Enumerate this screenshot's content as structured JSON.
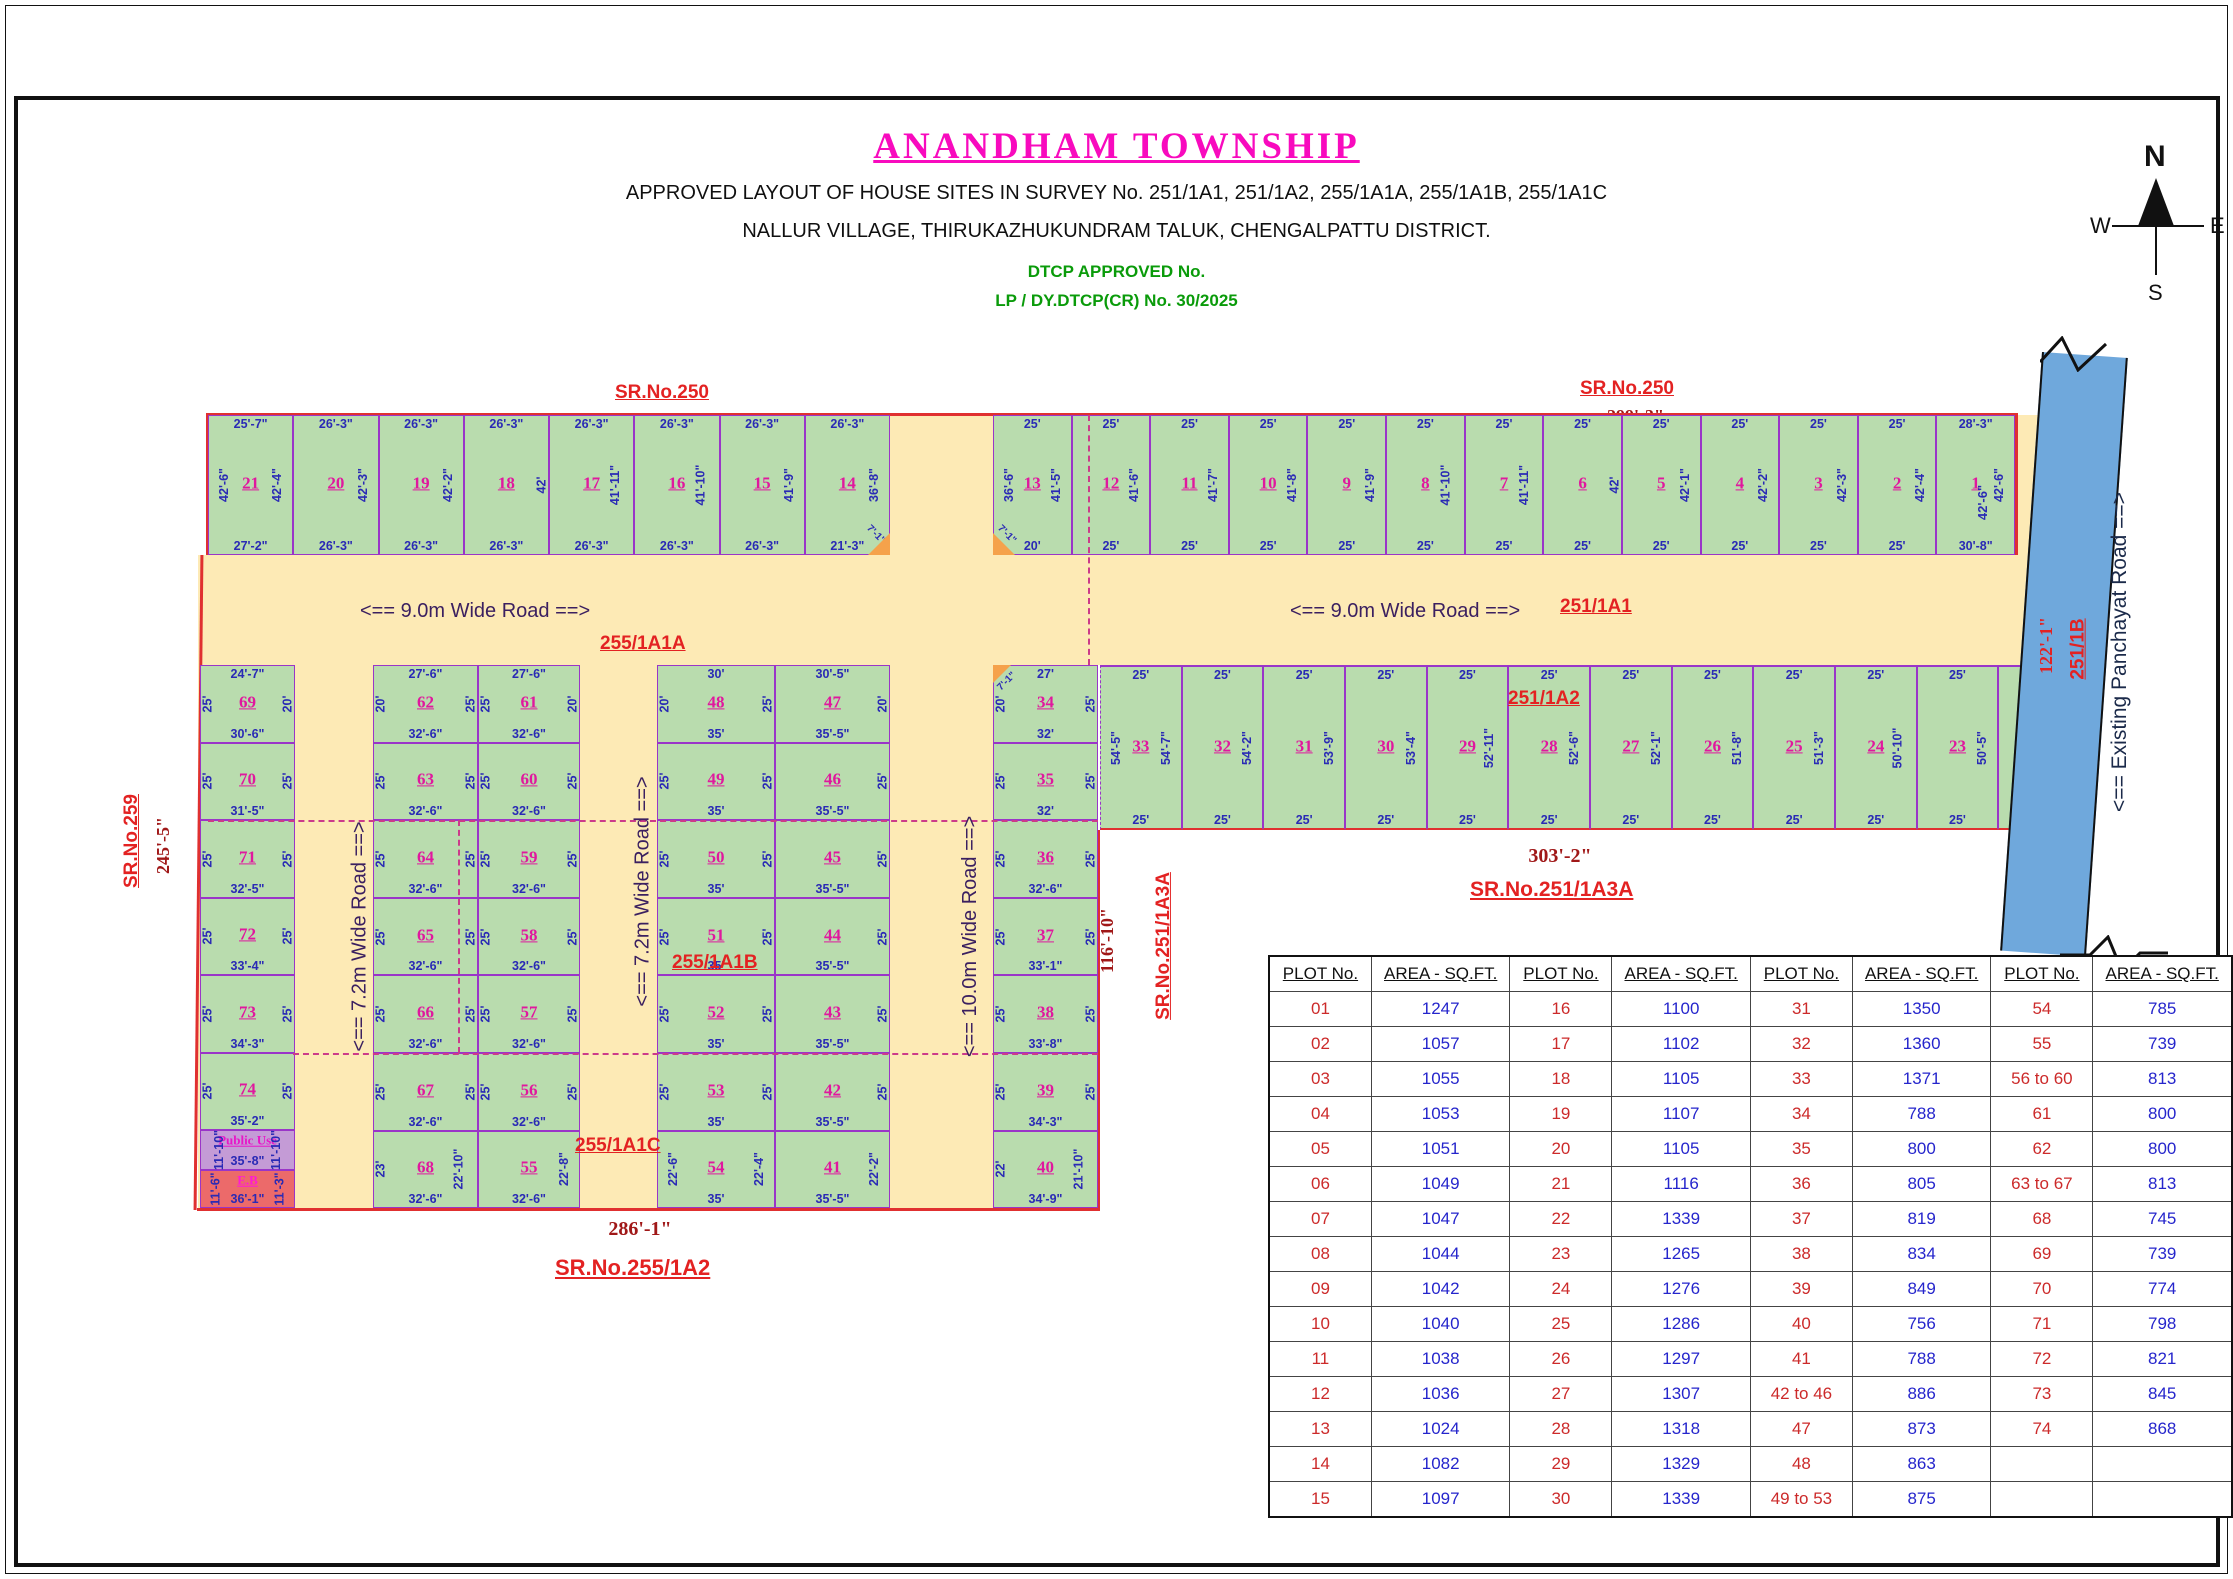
{
  "header": {
    "title": "ANANDHAM TOWNSHIP",
    "subtitle1": "APPROVED LAYOUT OF HOUSE SITES IN SURVEY No. 251/1A1, 251/1A2, 255/1A1A, 255/1A1B, 255/1A1C",
    "subtitle2": "NALLUR VILLAGE, THIRUKAZHUKUNDRAM TALUK, CHENGALPATTU DISTRICT.",
    "approval1": "DTCP APPROVED No.",
    "approval2": "LP / DY.DTCP(CR) No. 30/2025"
  },
  "compass": {
    "n": "N",
    "e": "E",
    "s": "S",
    "w": "W"
  },
  "labels": {
    "sr250_left": "SR.No.250",
    "dim250_left": "271'-2\"",
    "sr250_right": "SR.No.250",
    "dim250_right": "299'-3\"",
    "sr259": "SR.No.259",
    "dim259": "245'-5\"",
    "sr251_1a3a_side": "SR.No.251/1A3A",
    "dim116": "116'-10\"",
    "sr251_1a3a_bottom": "SR.No.251/1A3A",
    "dim303": "303'-2\"",
    "sr255_1a2": "SR.No.255/1A2",
    "dim286": "286'-1\"",
    "dim122": "122'-1\"",
    "r251_1b": "251/1B",
    "panchayat_road": "<== Existing Panchayat Road ==>",
    "road9": "<== 9.0m Wide Road ==>",
    "road72": "<== 7.2m Wide Road ==>",
    "road10": "<== 10.0m Wide Road ==>",
    "r255_1a1a": "255/1A1A",
    "r251_1a1": "251/1A1",
    "r251_1a2": "251/1A2",
    "r255_1a1b": "255/1A1B",
    "r255_1a1c": "255/1A1C",
    "plot1_right_dim": "42'-6\""
  },
  "plan": {
    "top_left_block": [
      {
        "n": "21",
        "t": "25'-7\"",
        "l": "42'-6\"",
        "r": "42'-4\"",
        "b": "27'-2\""
      },
      {
        "n": "20",
        "t": "26'-3\"",
        "r": "42'-3\"",
        "b": "26'-3\""
      },
      {
        "n": "19",
        "t": "26'-3\"",
        "r": "42'-2\"",
        "b": "26'-3\""
      },
      {
        "n": "18",
        "t": "26'-3\"",
        "r": "42'",
        "b": "26'-3\""
      },
      {
        "n": "17",
        "t": "26'-3\"",
        "r": "41'-11\"",
        "b": "26'-3\""
      },
      {
        "n": "16",
        "t": "26'-3\"",
        "r": "41'-10\"",
        "b": "26'-3\""
      },
      {
        "n": "15",
        "t": "26'-3\"",
        "r": "41'-9\"",
        "b": "26'-3\""
      },
      {
        "n": "14",
        "t": "26'-3\"",
        "r": "36'-8\"",
        "b": "21'-3\"",
        "c": "7'-1\""
      }
    ],
    "top_right_block": [
      {
        "n": "13",
        "t": "25'",
        "l": "36'-6\"",
        "r": "41'-5\"",
        "b": "20'",
        "c": "7'-1\""
      },
      {
        "n": "12",
        "t": "25'",
        "r": "41'-6\"",
        "b": "25'"
      },
      {
        "n": "11",
        "t": "25'",
        "r": "41'-7\"",
        "b": "25'"
      },
      {
        "n": "10",
        "t": "25'",
        "r": "41'-8\"",
        "b": "25'"
      },
      {
        "n": "9",
        "t": "25'",
        "r": "41'-9\"",
        "b": "25'"
      },
      {
        "n": "8",
        "t": "25'",
        "r": "41'-10\"",
        "b": "25'"
      },
      {
        "n": "7",
        "t": "25'",
        "r": "41'-11\"",
        "b": "25'"
      },
      {
        "n": "6",
        "t": "25'",
        "r": "42'",
        "b": "25'"
      },
      {
        "n": "5",
        "t": "25'",
        "r": "42'-1\"",
        "b": "25'"
      },
      {
        "n": "4",
        "t": "25'",
        "r": "42'-2\"",
        "b": "25'"
      },
      {
        "n": "3",
        "t": "25'",
        "r": "42'-3\"",
        "b": "25'"
      },
      {
        "n": "2",
        "t": "25'",
        "r": "42'-4\"",
        "b": "25'"
      },
      {
        "n": "1",
        "t": "28'-3\"",
        "r": "42'-6\"",
        "b": "30'-8\""
      }
    ],
    "col_69_74": [
      {
        "n": "69",
        "t": "24'-7\"",
        "l": "25'",
        "r": "20'",
        "b": "30'-6\""
      },
      {
        "n": "70",
        "l": "25'",
        "r": "25'",
        "b": "31'-5\""
      },
      {
        "n": "71",
        "l": "25'",
        "r": "25'",
        "b": "32'-5\""
      },
      {
        "n": "72",
        "l": "25'",
        "r": "25'",
        "b": "33'-4\""
      },
      {
        "n": "73",
        "l": "25'",
        "r": "25'",
        "b": "34'-3\""
      },
      {
        "n": "74",
        "l": "25'",
        "r": "25'",
        "b": "35'-2\""
      }
    ],
    "special_plots": [
      {
        "n": "Public Use",
        "l": "11'-10\"",
        "r": "11'-10\"",
        "b": "35'-8\""
      },
      {
        "n": "E.B",
        "l": "11'-6\"",
        "r": "11'-3\"",
        "b": "36'-1\""
      }
    ],
    "col_62_68": [
      {
        "n": "62",
        "t": "27'-6\"",
        "l": "20'",
        "r": "25'",
        "b": "32'-6\""
      },
      {
        "n": "63",
        "l": "25'",
        "r": "25'",
        "b": "32'-6\""
      },
      {
        "n": "64",
        "l": "25'",
        "r": "25'",
        "b": "32'-6\""
      },
      {
        "n": "65",
        "l": "25'",
        "r": "25'",
        "b": "32'-6\""
      },
      {
        "n": "66",
        "l": "25'",
        "r": "25'",
        "b": "32'-6\""
      },
      {
        "n": "67",
        "l": "25'",
        "r": "25'",
        "b": "32'-6\""
      },
      {
        "n": "68",
        "l": "23'",
        "r": "22'-10\"",
        "b": "32'-6\""
      }
    ],
    "col_61_55": [
      {
        "n": "61",
        "t": "27'-6\"",
        "l": "25'",
        "r": "20'",
        "b": "32'-6\""
      },
      {
        "n": "60",
        "l": "25'",
        "r": "25'",
        "b": "32'-6\""
      },
      {
        "n": "59",
        "l": "25'",
        "r": "25'",
        "b": "32'-6\""
      },
      {
        "n": "58",
        "l": "25'",
        "r": "25'",
        "b": "32'-6\""
      },
      {
        "n": "57",
        "l": "25'",
        "r": "25'",
        "b": "32'-6\""
      },
      {
        "n": "56",
        "l": "25'",
        "r": "25'",
        "b": "32'-6\""
      },
      {
        "n": "55",
        "r": "22'-8\"",
        "b": "32'-6\""
      }
    ],
    "col_48_54": [
      {
        "n": "48",
        "t": "30'",
        "l": "20'",
        "r": "25'",
        "b": "35'"
      },
      {
        "n": "49",
        "l": "25'",
        "r": "25'",
        "b": "35'"
      },
      {
        "n": "50",
        "l": "25'",
        "r": "25'",
        "b": "35'"
      },
      {
        "n": "51",
        "l": "25'",
        "r": "25'",
        "b": "35'"
      },
      {
        "n": "52",
        "l": "25'",
        "r": "25'",
        "b": "35'"
      },
      {
        "n": "53",
        "l": "25'",
        "r": "25'",
        "b": "35'"
      },
      {
        "n": "54",
        "l": "22'-6\"",
        "r": "22'-4\"",
        "b": "35'"
      }
    ],
    "col_47_41": [
      {
        "n": "47",
        "t": "30'-5\"",
        "r": "20'",
        "b": "35'-5\""
      },
      {
        "n": "46",
        "r": "25'",
        "b": "35'-5\""
      },
      {
        "n": "45",
        "r": "25'",
        "b": "35'-5\""
      },
      {
        "n": "44",
        "r": "25'",
        "b": "35'-5\""
      },
      {
        "n": "43",
        "r": "25'",
        "b": "35'-5\""
      },
      {
        "n": "42",
        "r": "25'",
        "b": "35'-5\""
      },
      {
        "n": "41",
        "r": "22'-2\"",
        "b": "35'-5\""
      }
    ],
    "col_34_40": [
      {
        "n": "34",
        "t": "27'",
        "l": "20'",
        "r": "25'",
        "b": "32'",
        "c": "7'-1\""
      },
      {
        "n": "35",
        "l": "25'",
        "r": "25'",
        "b": "32'"
      },
      {
        "n": "36",
        "l": "25'",
        "r": "25'",
        "b": "32'-6\""
      },
      {
        "n": "37",
        "l": "25'",
        "r": "25'",
        "b": "33'-1\""
      },
      {
        "n": "38",
        "l": "25'",
        "r": "25'",
        "b": "33'-8\""
      },
      {
        "n": "39",
        "l": "25'",
        "r": "25'",
        "b": "34'-3\""
      },
      {
        "n": "40",
        "l": "22'",
        "r": "21'-10\"",
        "b": "34'-9\""
      }
    ],
    "right_row_33_22": [
      {
        "n": "33",
        "t": "25'",
        "lside": "54'-5\"",
        "rside": "54'-7\"",
        "b": "25'"
      },
      {
        "n": "32",
        "t": "25'",
        "rside": "54'-2\"",
        "b": "25'"
      },
      {
        "n": "31",
        "t": "25'",
        "rside": "53'-9\"",
        "b": "25'"
      },
      {
        "n": "30",
        "t": "25'",
        "rside": "53'-4\"",
        "b": "25'"
      },
      {
        "n": "29",
        "t": "25'",
        "rside": "52'-11\"",
        "b": "25'"
      },
      {
        "n": "28",
        "t": "25'",
        "rside": "52'-6\"",
        "b": "25'"
      },
      {
        "n": "27",
        "t": "25'",
        "rside": "52'-1\"",
        "b": "25'"
      },
      {
        "n": "26",
        "t": "25'",
        "rside": "51'-8\"",
        "b": "25'"
      },
      {
        "n": "25",
        "t": "25'",
        "rside": "51'-3\"",
        "b": "25'"
      },
      {
        "n": "24",
        "t": "25'",
        "rside": "50'-10\"",
        "b": "25'"
      },
      {
        "n": "23",
        "t": "25'",
        "rside": "50'-5\"",
        "b": "25'"
      },
      {
        "n": "22",
        "t": "25'-3\"",
        "rside": "50'",
        "b": "28'-1\""
      }
    ]
  },
  "table": {
    "headers": [
      "PLOT No.",
      "AREA - SQ.FT.",
      "PLOT No.",
      "AREA - SQ.FT.",
      "PLOT No.",
      "AREA - SQ.FT.",
      "PLOT No.",
      "AREA - SQ.FT."
    ],
    "rows": [
      [
        "01",
        "1247",
        "16",
        "1100",
        "31",
        "1350",
        "54",
        "785"
      ],
      [
        "02",
        "1057",
        "17",
        "1102",
        "32",
        "1360",
        "55",
        "739"
      ],
      [
        "03",
        "1055",
        "18",
        "1105",
        "33",
        "1371",
        "56 to 60",
        "813"
      ],
      [
        "04",
        "1053",
        "19",
        "1107",
        "34",
        "788",
        "61",
        "800"
      ],
      [
        "05",
        "1051",
        "20",
        "1105",
        "35",
        "800",
        "62",
        "800"
      ],
      [
        "06",
        "1049",
        "21",
        "1116",
        "36",
        "805",
        "63 to 67",
        "813"
      ],
      [
        "07",
        "1047",
        "22",
        "1339",
        "37",
        "819",
        "68",
        "745"
      ],
      [
        "08",
        "1044",
        "23",
        "1265",
        "38",
        "834",
        "69",
        "739"
      ],
      [
        "09",
        "1042",
        "24",
        "1276",
        "39",
        "849",
        "70",
        "774"
      ],
      [
        "10",
        "1040",
        "25",
        "1286",
        "40",
        "756",
        "71",
        "798"
      ],
      [
        "11",
        "1038",
        "26",
        "1297",
        "41",
        "788",
        "72",
        "821"
      ],
      [
        "12",
        "1036",
        "27",
        "1307",
        "42 to 46",
        "886",
        "73",
        "845"
      ],
      [
        "13",
        "1024",
        "28",
        "1318",
        "47",
        "873",
        "74",
        "868"
      ],
      [
        "14",
        "1082",
        "29",
        "1329",
        "48",
        "863",
        "",
        ""
      ],
      [
        "15",
        "1097",
        "30",
        "1339",
        "49 to 53",
        "875",
        "",
        ""
      ]
    ]
  }
}
